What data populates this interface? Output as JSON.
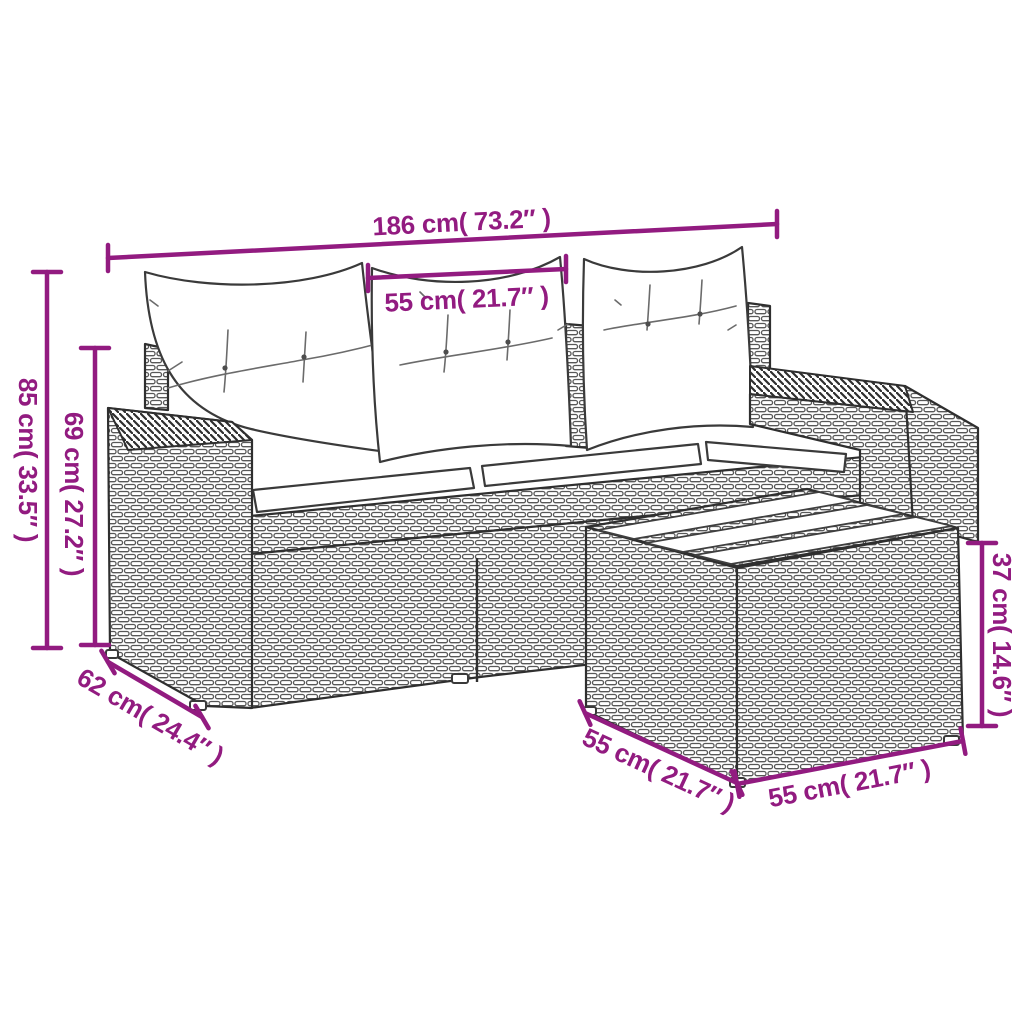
{
  "diagram": {
    "dims": {
      "sofa_width": "186 cm( 73.2″ )",
      "seat_width": "55 cm( 21.7″ )",
      "sofa_height": "85 cm( 33.5″ )",
      "arm_height": "69 cm( 27.2″ )",
      "sofa_depth": "62 cm( 24.4″ )",
      "table_depth": "55 cm( 21.7″ )",
      "table_width": "55 cm( 21.7″ )",
      "table_height": "37 cm( 14.6″ )"
    },
    "colors": {
      "dimension_accent": "#921B80",
      "line_art": "#2F2F2F",
      "background": "#FFFFFF"
    }
  }
}
